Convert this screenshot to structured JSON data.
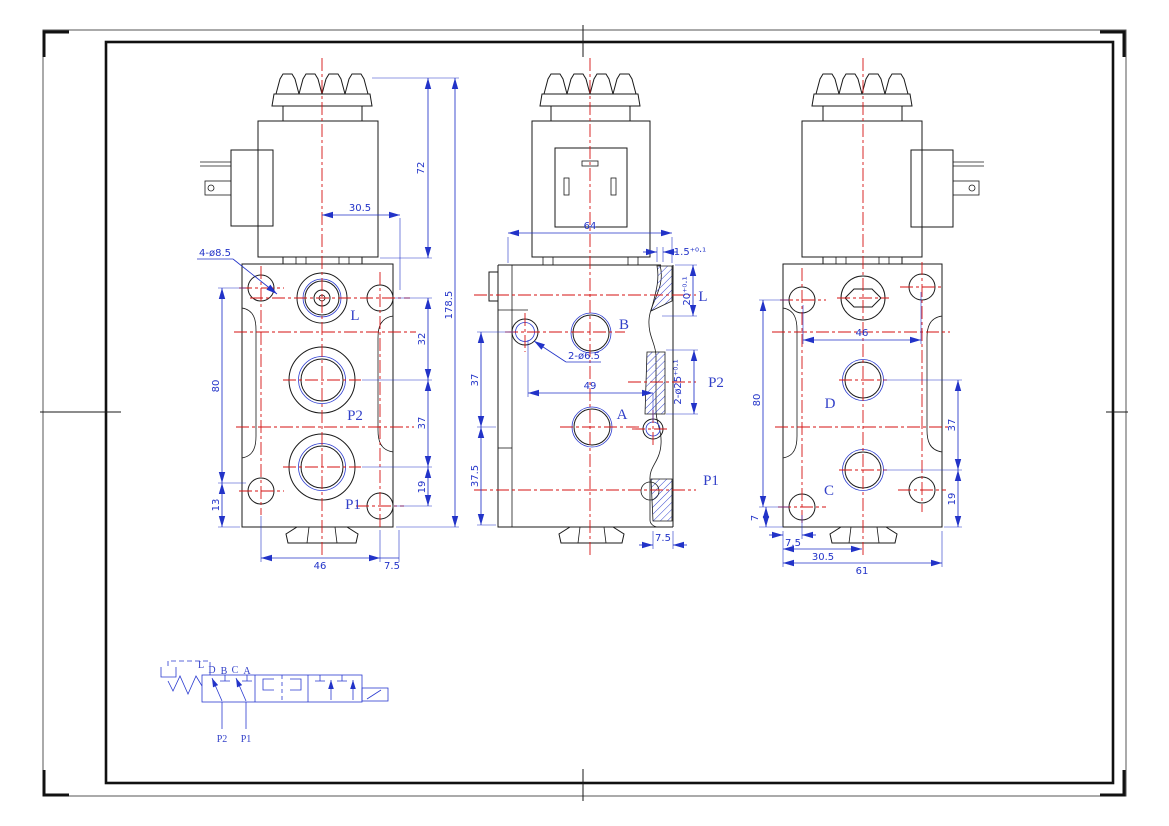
{
  "sheet": {
    "background": "#ffffff",
    "outline_color": "#1a1a1a",
    "centerline_color": "#d51212",
    "dimension_color": "#2233c8",
    "port_label_color": "#3240c8"
  },
  "front_view": {
    "lead_label": "4-ø8.5",
    "dims": {
      "d30_5": "30.5",
      "d72": "72",
      "d178_5": "178.5",
      "d32": "32",
      "d37": "37",
      "d19": "19",
      "d80": "80",
      "d13": "13",
      "d46": "46",
      "d7_5": "7.5"
    },
    "ports": {
      "l": "L",
      "p2": "P2",
      "p1": "P1"
    }
  },
  "side_view": {
    "lead_label": "2-ø6.5",
    "dims": {
      "d64": "64",
      "d1_5": "1.5⁺⁰·¹",
      "d20": "20⁺⁰·¹",
      "d2_25": "2-ø25⁺⁰·¹",
      "d49": "49",
      "d37": "37",
      "d37_5": "37.5",
      "d7_5": "7.5"
    },
    "ports": {
      "b": "B",
      "a": "A",
      "l": "L",
      "p2": "P2",
      "p1": "P1"
    }
  },
  "back_view": {
    "dims": {
      "d46": "46",
      "d80": "80",
      "d7": "7",
      "d37": "37",
      "d19": "19",
      "d7_5": "7.5",
      "d30_5": "30.5",
      "d61": "61"
    },
    "ports": {
      "d": "D",
      "c": "C"
    }
  },
  "schematic": {
    "labels": {
      "l": "L",
      "d": "D",
      "b": "B",
      "c": "C",
      "a": "A",
      "p2": "P2",
      "p1": "P1"
    }
  }
}
